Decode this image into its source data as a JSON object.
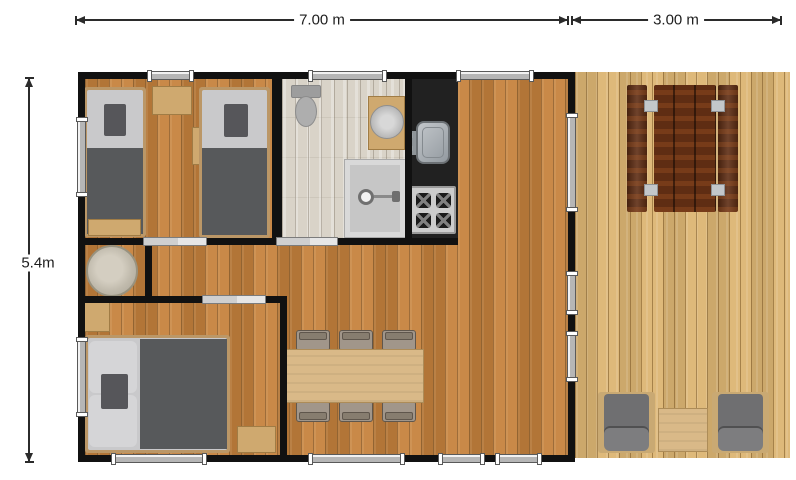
{
  "title": "Chalet / mobile home floor plan with side deck",
  "dimensions": {
    "top_main": "7.00 m",
    "top_deck": "3.00 m",
    "left": "5.4m"
  },
  "colors": {
    "wall": "#111111",
    "floor_main": "#c6823d",
    "floor_bathroom": "#d9d3c8",
    "floor_deck": "#dcb573",
    "kitchen_counter": "#212121",
    "bed_blanket": "#57595b",
    "mattress": "#c9c9cb",
    "light_wood": "#cfa96f",
    "dining_table": "#d9b988",
    "picnic_table_wood": "#5f2d13",
    "armchair_cushion": "#6f6f71",
    "dimension_line": "#2b2b2b"
  },
  "rooms": {
    "twin_bedroom": {
      "furniture": [
        "single-bed",
        "single-bed",
        "nightstand",
        "wall-shelf",
        "foot-bench"
      ]
    },
    "bathroom": {
      "furniture": [
        "toilet",
        "vanity-with-round-basin",
        "shower"
      ]
    },
    "kitchen": {
      "furniture": [
        "black-counter",
        "sink",
        "hob-4-burners"
      ]
    },
    "storage_nook": {
      "furniture": [
        "round-basin"
      ]
    },
    "hallway": {
      "furniture": []
    },
    "double_bedroom": {
      "furniture": [
        "double-bed",
        "nightstand",
        "nightstand"
      ]
    },
    "living_dining": {
      "furniture": [
        "dining-table",
        "chair",
        "chair",
        "chair",
        "chair",
        "chair",
        "chair"
      ]
    },
    "deck": {
      "furniture": [
        "picnic-bench",
        "picnic-table",
        "picnic-bench",
        "armchair",
        "side-table",
        "armchair"
      ]
    }
  },
  "openings": {
    "windows_top": 3,
    "windows_bottom": 4,
    "windows_left": 2,
    "windows_right": 2,
    "glass_door_right": 1,
    "interior_sliding_doors": 3
  }
}
